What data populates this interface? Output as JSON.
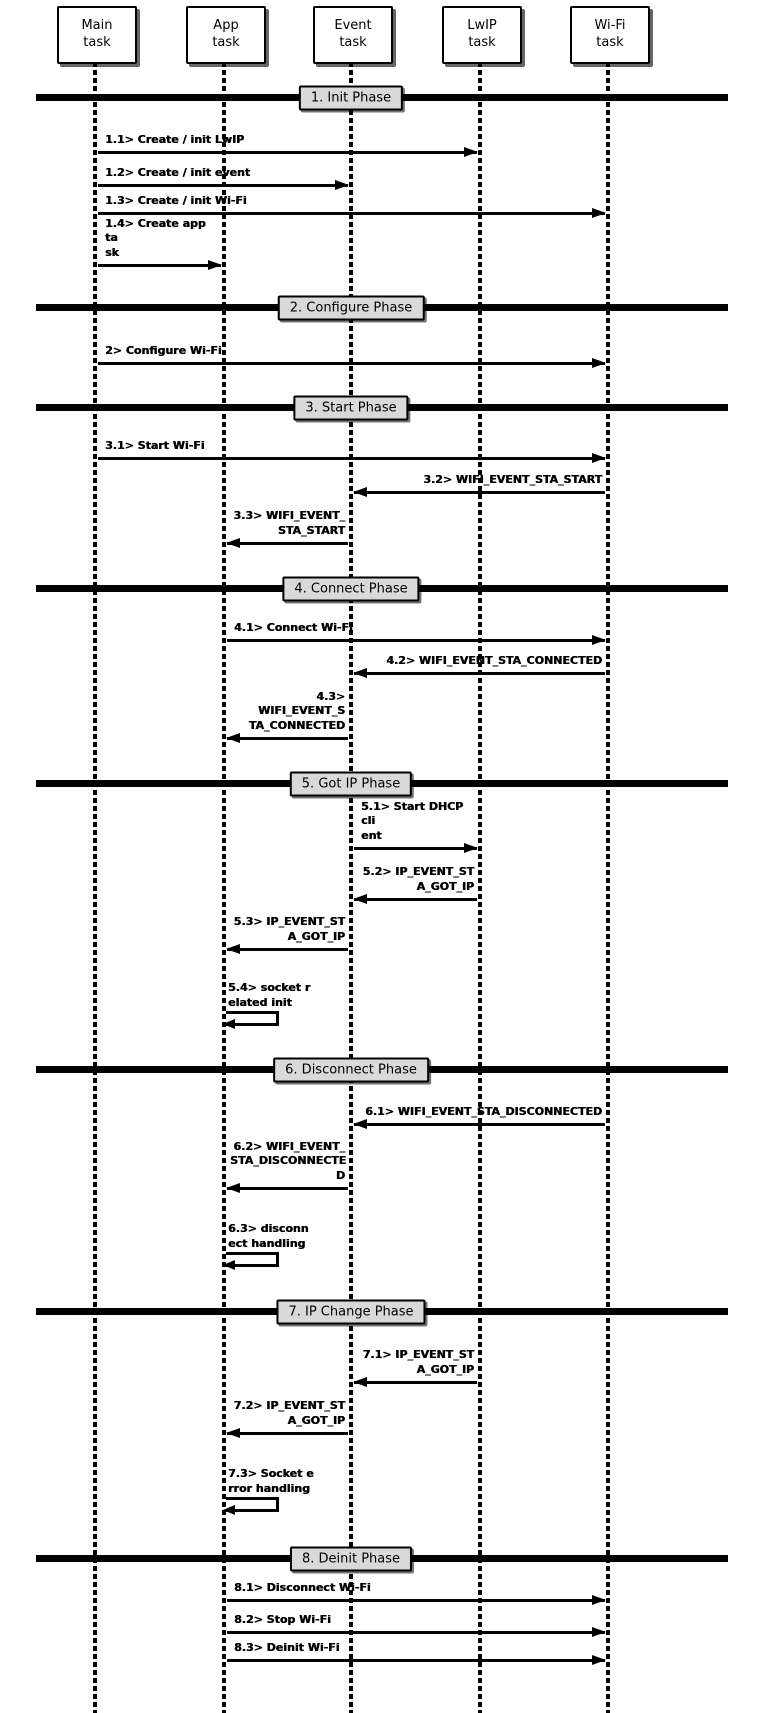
{
  "actors": [
    {
      "label": "Main\ntask"
    },
    {
      "label": "App\ntask"
    },
    {
      "label": "Event\ntask"
    },
    {
      "label": "LwIP\ntask"
    },
    {
      "label": "Wi-Fi\ntask"
    }
  ],
  "phases": [
    {
      "label": "1. Init Phase"
    },
    {
      "label": "2. Configure Phase"
    },
    {
      "label": "3. Start Phase"
    },
    {
      "label": "4. Connect Phase"
    },
    {
      "label": "5. Got IP Phase"
    },
    {
      "label": "6. Disconnect Phase"
    },
    {
      "label": "7. IP Change Phase"
    },
    {
      "label": "8. Deinit Phase"
    }
  ],
  "messages": [
    {
      "id": "1.1",
      "label": "1.1> Create / init LwIP",
      "from": "Main task",
      "to": "LwIP task",
      "type": "message"
    },
    {
      "id": "1.2",
      "label": "1.2> Create / init event",
      "from": "Main task",
      "to": "Event task",
      "type": "message"
    },
    {
      "id": "1.3",
      "label": "1.3> Create / init Wi-Fi",
      "from": "Main task",
      "to": "Wi-Fi task",
      "type": "message"
    },
    {
      "id": "1.4",
      "label": "1.4> Create app ta\nsk",
      "from": "Main task",
      "to": "App task",
      "type": "message"
    },
    {
      "id": "2",
      "label": "2> Configure Wi-Fi",
      "from": "Main task",
      "to": "Wi-Fi task",
      "type": "message"
    },
    {
      "id": "3.1",
      "label": "3.1> Start Wi-Fi",
      "from": "Main task",
      "to": "Wi-Fi task",
      "type": "message"
    },
    {
      "id": "3.2",
      "label": "3.2> WIFI_EVENT_STA_START",
      "from": "Wi-Fi task",
      "to": "Event task",
      "type": "message"
    },
    {
      "id": "3.3",
      "label": "3.3> WIFI_EVENT_\nSTA_START",
      "from": "Event task",
      "to": "App task",
      "type": "message"
    },
    {
      "id": "4.1",
      "label": "4.1> Connect Wi-Fi",
      "from": "App task",
      "to": "Wi-Fi task",
      "type": "message"
    },
    {
      "id": "4.2",
      "label": "4.2> WIFI_EVENT_STA_CONNECTED",
      "from": "Wi-Fi task",
      "to": "Event task",
      "type": "message"
    },
    {
      "id": "4.3",
      "label": "4.3> WIFI_EVENT_S\nTA_CONNECTED",
      "from": "Event task",
      "to": "App task",
      "type": "message"
    },
    {
      "id": "5.1",
      "label": "5.1> Start DHCP cli\nent",
      "from": "Event task",
      "to": "LwIP task",
      "type": "message"
    },
    {
      "id": "5.2",
      "label": "5.2> IP_EVENT_ST\nA_GOT_IP",
      "from": "LwIP task",
      "to": "Event task",
      "type": "message"
    },
    {
      "id": "5.3",
      "label": "5.3> IP_EVENT_ST\nA_GOT_IP",
      "from": "Event task",
      "to": "App task",
      "type": "message"
    },
    {
      "id": "5.4",
      "label": "5.4> socket r\nelated init",
      "from": "App task",
      "to": "App task",
      "type": "self"
    },
    {
      "id": "6.1",
      "label": "6.1> WIFI_EVENT_STA_DISCONNECTED",
      "from": "Wi-Fi task",
      "to": "Event task",
      "type": "message"
    },
    {
      "id": "6.2",
      "label": "6.2> WIFI_EVENT_\nSTA_DISCONNECTE\nD",
      "from": "Event task",
      "to": "App task",
      "type": "message"
    },
    {
      "id": "6.3",
      "label": "6.3> disconn\nect handling",
      "from": "App task",
      "to": "App task",
      "type": "self"
    },
    {
      "id": "7.1",
      "label": "7.1> IP_EVENT_ST\nA_GOT_IP",
      "from": "LwIP task",
      "to": "Event task",
      "type": "message"
    },
    {
      "id": "7.2",
      "label": "7.2> IP_EVENT_ST\nA_GOT_IP",
      "from": "Event task",
      "to": "App task",
      "type": "message"
    },
    {
      "id": "7.3",
      "label": "7.3> Socket e\nrror handling",
      "from": "App task",
      "to": "App task",
      "type": "self"
    },
    {
      "id": "8.1",
      "label": "8.1> Disconnect Wi-Fi",
      "from": "App task",
      "to": "Wi-Fi task",
      "type": "message"
    },
    {
      "id": "8.2",
      "label": "8.2> Stop Wi-Fi",
      "from": "App task",
      "to": "Wi-Fi task",
      "type": "message"
    },
    {
      "id": "8.3",
      "label": "8.3> Deinit Wi-Fi",
      "from": "App task",
      "to": "Wi-Fi task",
      "type": "message"
    }
  ],
  "colors": {
    "line": "#000000",
    "phase_fill": "#d9d9d9",
    "background": "#ffffff"
  }
}
